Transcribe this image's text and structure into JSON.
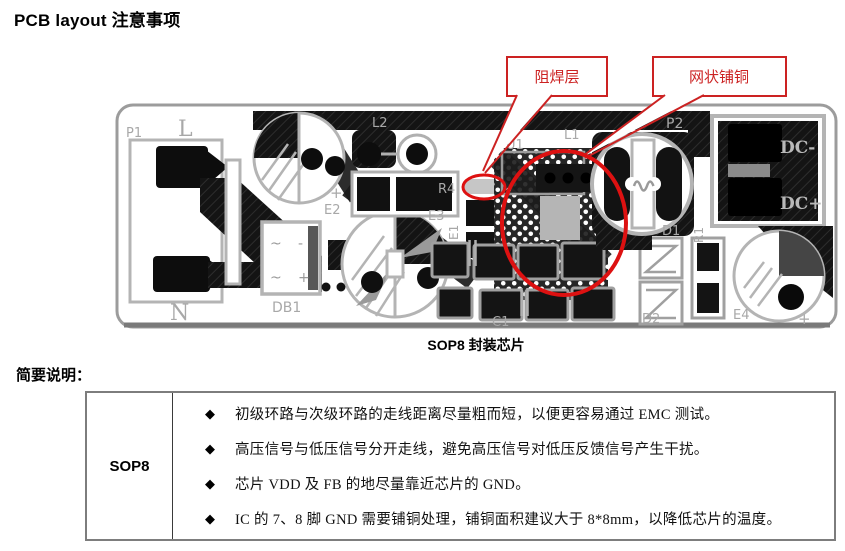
{
  "page": {
    "title": "PCB layout 注意事项"
  },
  "figure": {
    "caption": "SOP8 封装芯片",
    "callouts": [
      {
        "label": "阻焊层"
      },
      {
        "label": "网状铺铜"
      }
    ],
    "silkscreen": {
      "p1": "P1",
      "l": "L",
      "n": "N",
      "db1": "DB1",
      "e2": "E2",
      "e2_plus": "+",
      "e3": "E3",
      "e1": "E1",
      "e4": "E4",
      "e4_plus": "+",
      "l2": "L2",
      "r4": "R4",
      "u1": "U1",
      "l1": "L1",
      "p2": "P2",
      "dc_minus": "DC-",
      "dc_plus": "DC+",
      "d1": "D1",
      "r1": "R1",
      "d2": "D2",
      "c1": "C1",
      "db1_tilde_top": "~",
      "db1_minus": "-",
      "db1_tilde_bottom": "~",
      "db1_plus": "+"
    },
    "colors": {
      "annotation_red": "#cc2222",
      "highlight_red": "#dd1111",
      "silkscreen_gray": "#a8a8a8",
      "copper_dark": "#161616"
    }
  },
  "notes": {
    "heading": "简要说明：",
    "row_label": "SOP8",
    "bullet_glyph": "◆",
    "items": [
      "初级环路与次级环路的走线距离尽量粗而短，以便更容易通过 EMC 测试。",
      "高压信号与低压信号分开走线，避免高压信号对低压反馈信号产生干扰。",
      "芯片 VDD 及 FB 的地尽量靠近芯片的 GND。",
      "IC 的 7、8 脚 GND 需要铺铜处理，铺铜面积建议大于 8*8mm，以降低芯片的温度。"
    ]
  }
}
